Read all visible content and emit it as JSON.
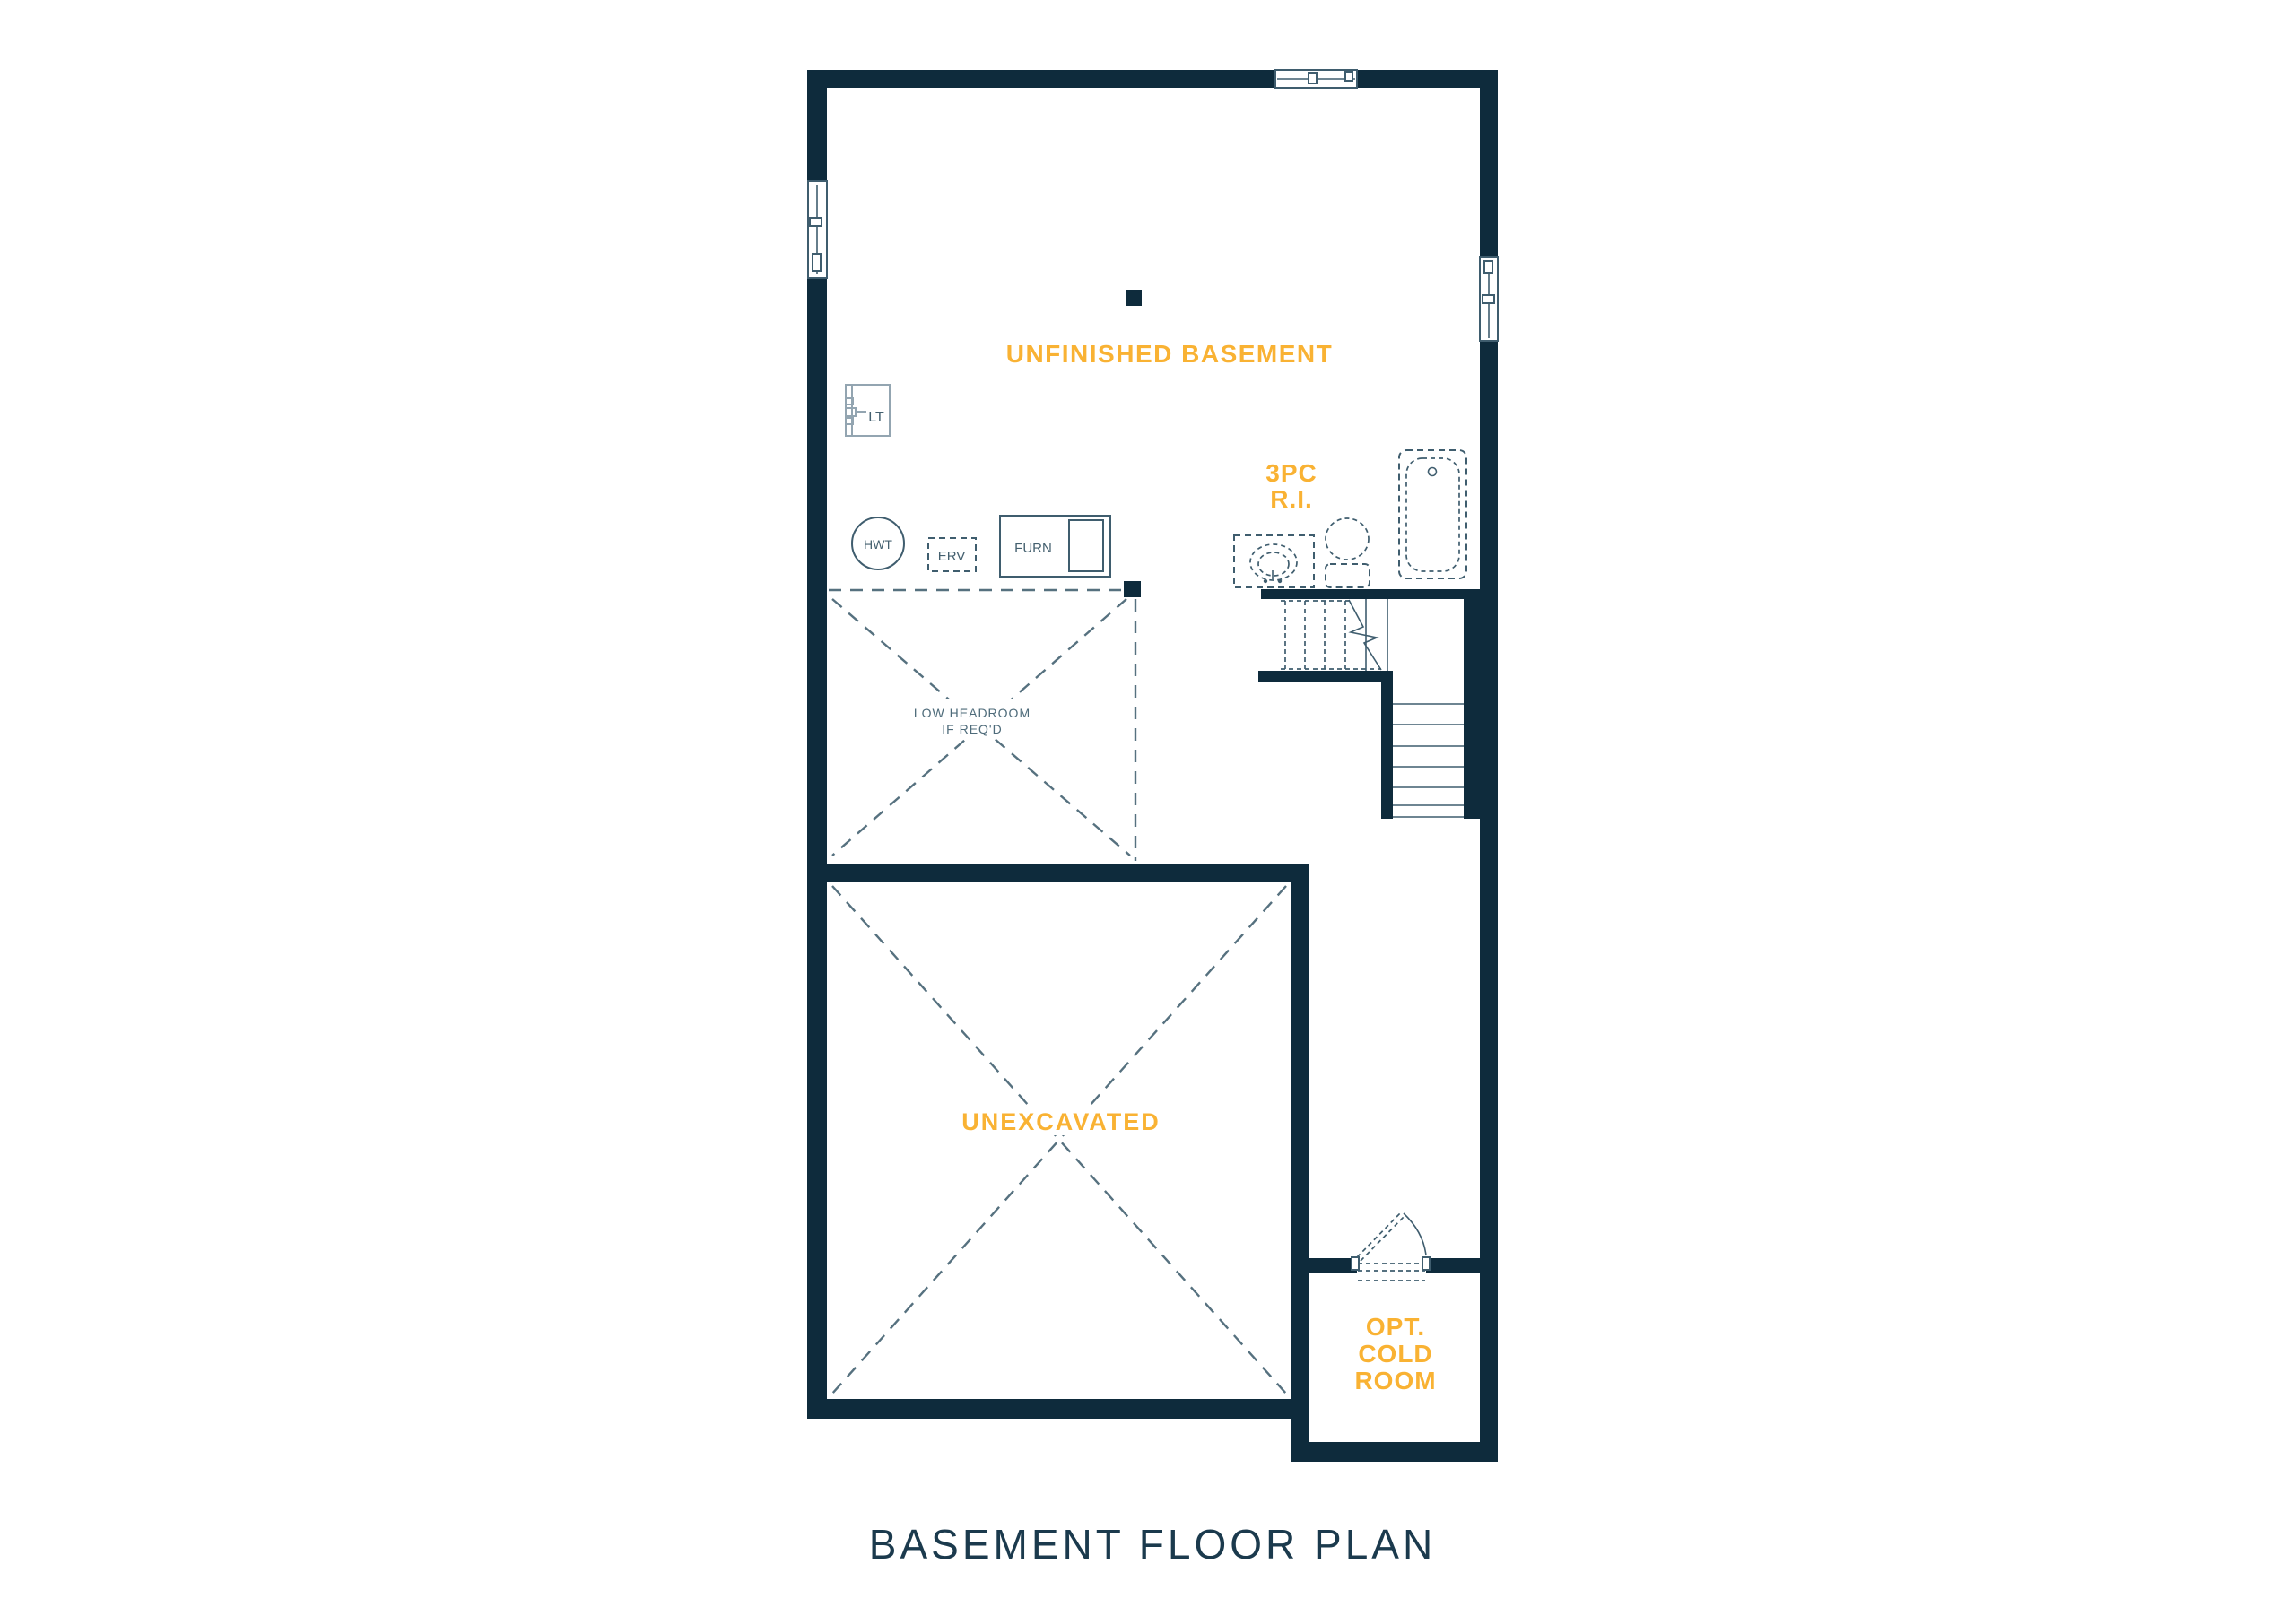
{
  "page": {
    "title": "BASEMENT FLOOR PLAN"
  },
  "colors": {
    "wall": "#0E2B3C",
    "accent": "#F9B233",
    "line": "#3F5D6E",
    "dash": "#56717F",
    "light_line": "#93A5B1",
    "muted_label": "#4E6B7A",
    "fixture_label": "#44606F",
    "title": "#1B3A4D",
    "background": "#FFFFFF"
  },
  "rooms": {
    "unfinished_basement": "UNFINISHED BASEMENT",
    "unexcavated": "UNEXCAVATED",
    "bath_rough_in": {
      "line1": "3PC",
      "line2": "R.I."
    },
    "low_headroom": {
      "line1": "LOW HEADROOM",
      "line2": "IF REQ'D"
    },
    "cold_room": {
      "line1": "OPT.",
      "line2": "COLD",
      "line3": "ROOM"
    }
  },
  "fixtures": {
    "laundry_tub": "LT",
    "hot_water_tank": "HWT",
    "erv": "ERV",
    "furnace": "FURN"
  }
}
